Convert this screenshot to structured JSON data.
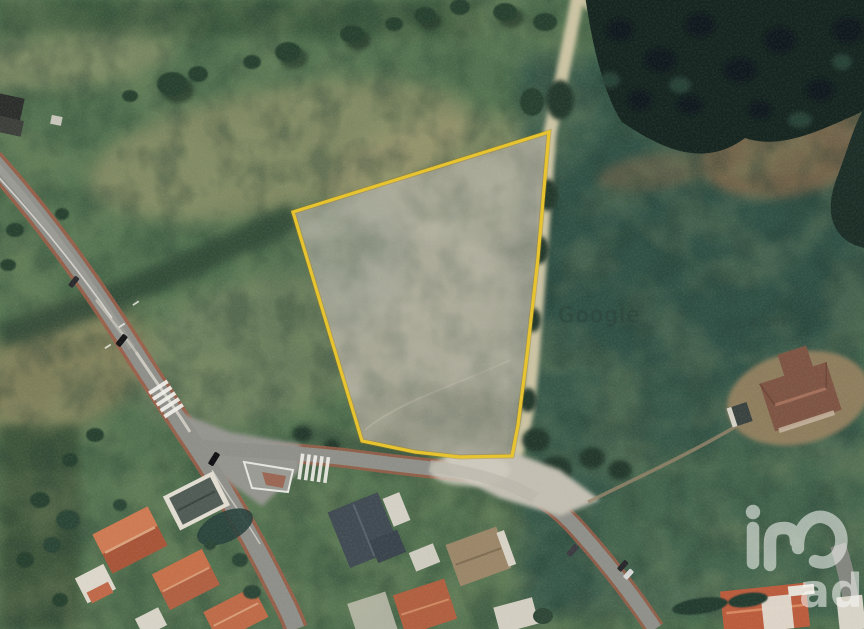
{
  "watermarks": {
    "map_attribution": "Google",
    "copyright": "© 202",
    "brand_monogram": "iad",
    "brand_suffix": "ad"
  },
  "parcel": {
    "outline_color": "#e9c42b",
    "halo_color": "#9c7b10",
    "fill_color": "#a3a292",
    "points": "293,212 549,132 538,258 527,355 518,425 512,456 460,457 415,452 362,441"
  },
  "palette": {
    "field_green": "#51714f",
    "field_teal": "#35564a",
    "forest_dark": "#15241f",
    "scrub_dark": "#2f4736",
    "path_tan": "#d3c9a8",
    "road_gray": "#8f8f8a",
    "road_red_edge": "#9c5e49",
    "gravel": "#c3bfb2",
    "roof_orange": "#c06543",
    "roof_slate": "#404a52",
    "roof_brown": "#7e5443",
    "dirt_brown": "#93805f"
  }
}
